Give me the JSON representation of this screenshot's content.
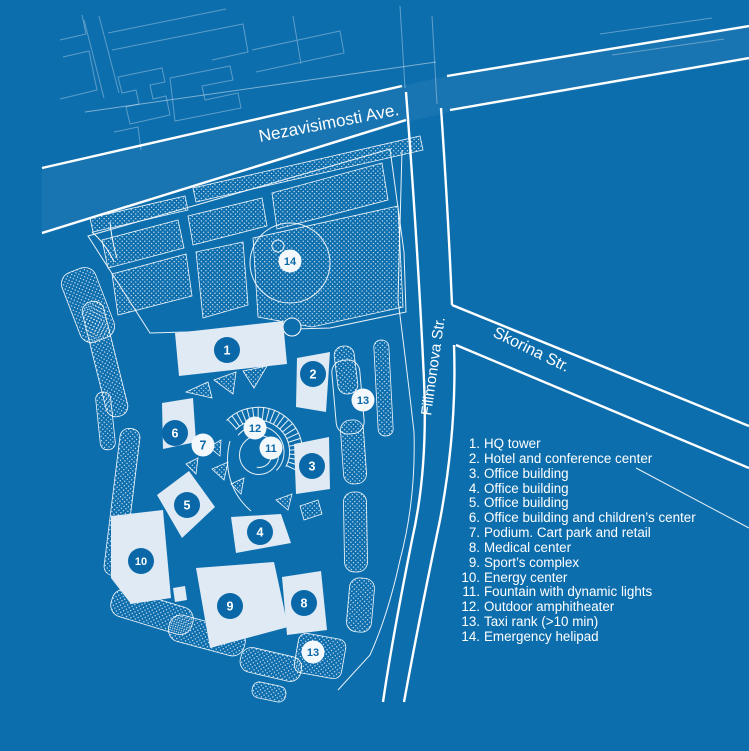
{
  "colors": {
    "background": "#0d6eae",
    "building_fill": "#dfeaf4",
    "line": "#ffffff",
    "marker_blue": "#0b68a8",
    "marker_white": "#f3f8fc"
  },
  "streets": {
    "avenue_label": "Nezavisimosti Ave.",
    "north_south_label": "Filimonova Str.",
    "diagonal_label": "Skorina Str."
  },
  "legend": {
    "items": [
      {
        "num": "1.",
        "label": "HQ tower"
      },
      {
        "num": "2.",
        "label": "Hotel and conference center"
      },
      {
        "num": "3.",
        "label": "Office building"
      },
      {
        "num": "4.",
        "label": "Office building"
      },
      {
        "num": "5.",
        "label": "Office building"
      },
      {
        "num": "6.",
        "label": "Office building and children’s center"
      },
      {
        "num": "7.",
        "label": "Podium. Cart park and retail"
      },
      {
        "num": "8.",
        "label": "Medical center"
      },
      {
        "num": "9.",
        "label": "Sport’s complex"
      },
      {
        "num": "10.",
        "label": "Energy center"
      },
      {
        "num": "11.",
        "label": "Fountain with dynamic lights"
      },
      {
        "num": "12.",
        "label": "Outdoor amphitheater"
      },
      {
        "num": "13.",
        "label": "Taxi rank (>10 min)"
      },
      {
        "num": "14.",
        "label": "Emergency helipad"
      }
    ]
  },
  "markers": [
    {
      "n": "1",
      "x": 227,
      "y": 350,
      "style": "blue"
    },
    {
      "n": "2",
      "x": 313,
      "y": 374,
      "style": "blue"
    },
    {
      "n": "3",
      "x": 312,
      "y": 466,
      "style": "blue"
    },
    {
      "n": "4",
      "x": 260,
      "y": 532,
      "style": "blue"
    },
    {
      "n": "5",
      "x": 187,
      "y": 505,
      "style": "blue"
    },
    {
      "n": "6",
      "x": 175,
      "y": 433,
      "style": "blue"
    },
    {
      "n": "7",
      "x": 203,
      "y": 445,
      "style": "white"
    },
    {
      "n": "8",
      "x": 304,
      "y": 603,
      "style": "blue"
    },
    {
      "n": "9",
      "x": 230,
      "y": 606,
      "style": "blue"
    },
    {
      "n": "10",
      "x": 141,
      "y": 561,
      "style": "blue"
    },
    {
      "n": "11",
      "x": 271,
      "y": 448,
      "style": "white"
    },
    {
      "n": "12",
      "x": 255,
      "y": 428,
      "style": "white"
    },
    {
      "n": "13",
      "x": 363,
      "y": 400,
      "style": "white"
    },
    {
      "n": "13",
      "x": 313,
      "y": 652,
      "style": "white"
    },
    {
      "n": "14",
      "x": 290,
      "y": 261,
      "style": "white"
    }
  ]
}
